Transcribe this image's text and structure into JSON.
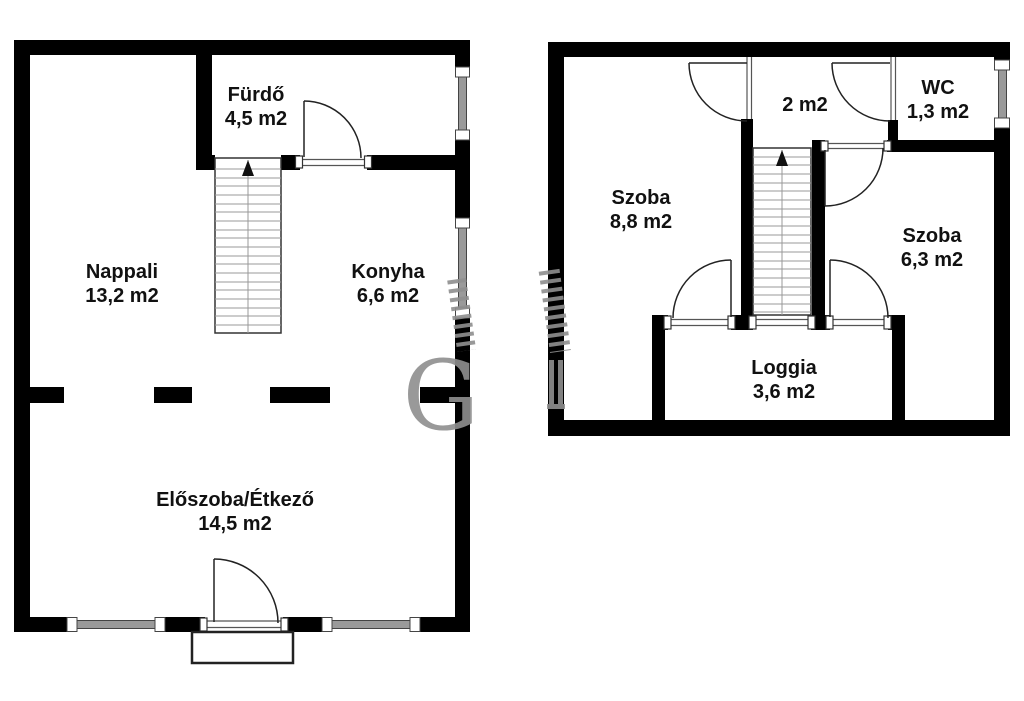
{
  "floors": {
    "ground": {
      "rooms": {
        "furdo": {
          "name": "Fürdő",
          "area": "4,5 m2"
        },
        "nappali": {
          "name": "Nappali",
          "area": "13,2 m2"
        },
        "konyha": {
          "name": "Konyha",
          "area": "6,6 m2"
        },
        "eloszoba": {
          "name": "Előszoba/Étkező",
          "area": "14,5 m2"
        }
      }
    },
    "upper": {
      "rooms": {
        "landing": {
          "area": "2 m2"
        },
        "wc": {
          "name": "WC",
          "area": "1,3 m2"
        },
        "szoba_8_8": {
          "name": "Szoba",
          "area": "8,8 m2"
        },
        "szoba_6_3": {
          "name": "Szoba",
          "area": "6,3 m2"
        },
        "loggia": {
          "name": "Loggia",
          "area": "3,6 m2"
        }
      }
    }
  },
  "watermark": {
    "letter": "G"
  },
  "colors": {
    "wall": "#000000",
    "background": "#ffffff",
    "text": "#111111",
    "thin_line": "#333333",
    "door_line": "#222222",
    "sill_line": "#555555",
    "step_line": "#999999",
    "glazing_gray": "#9a9a9a",
    "watermark_gray": "#8f8f8f"
  }
}
